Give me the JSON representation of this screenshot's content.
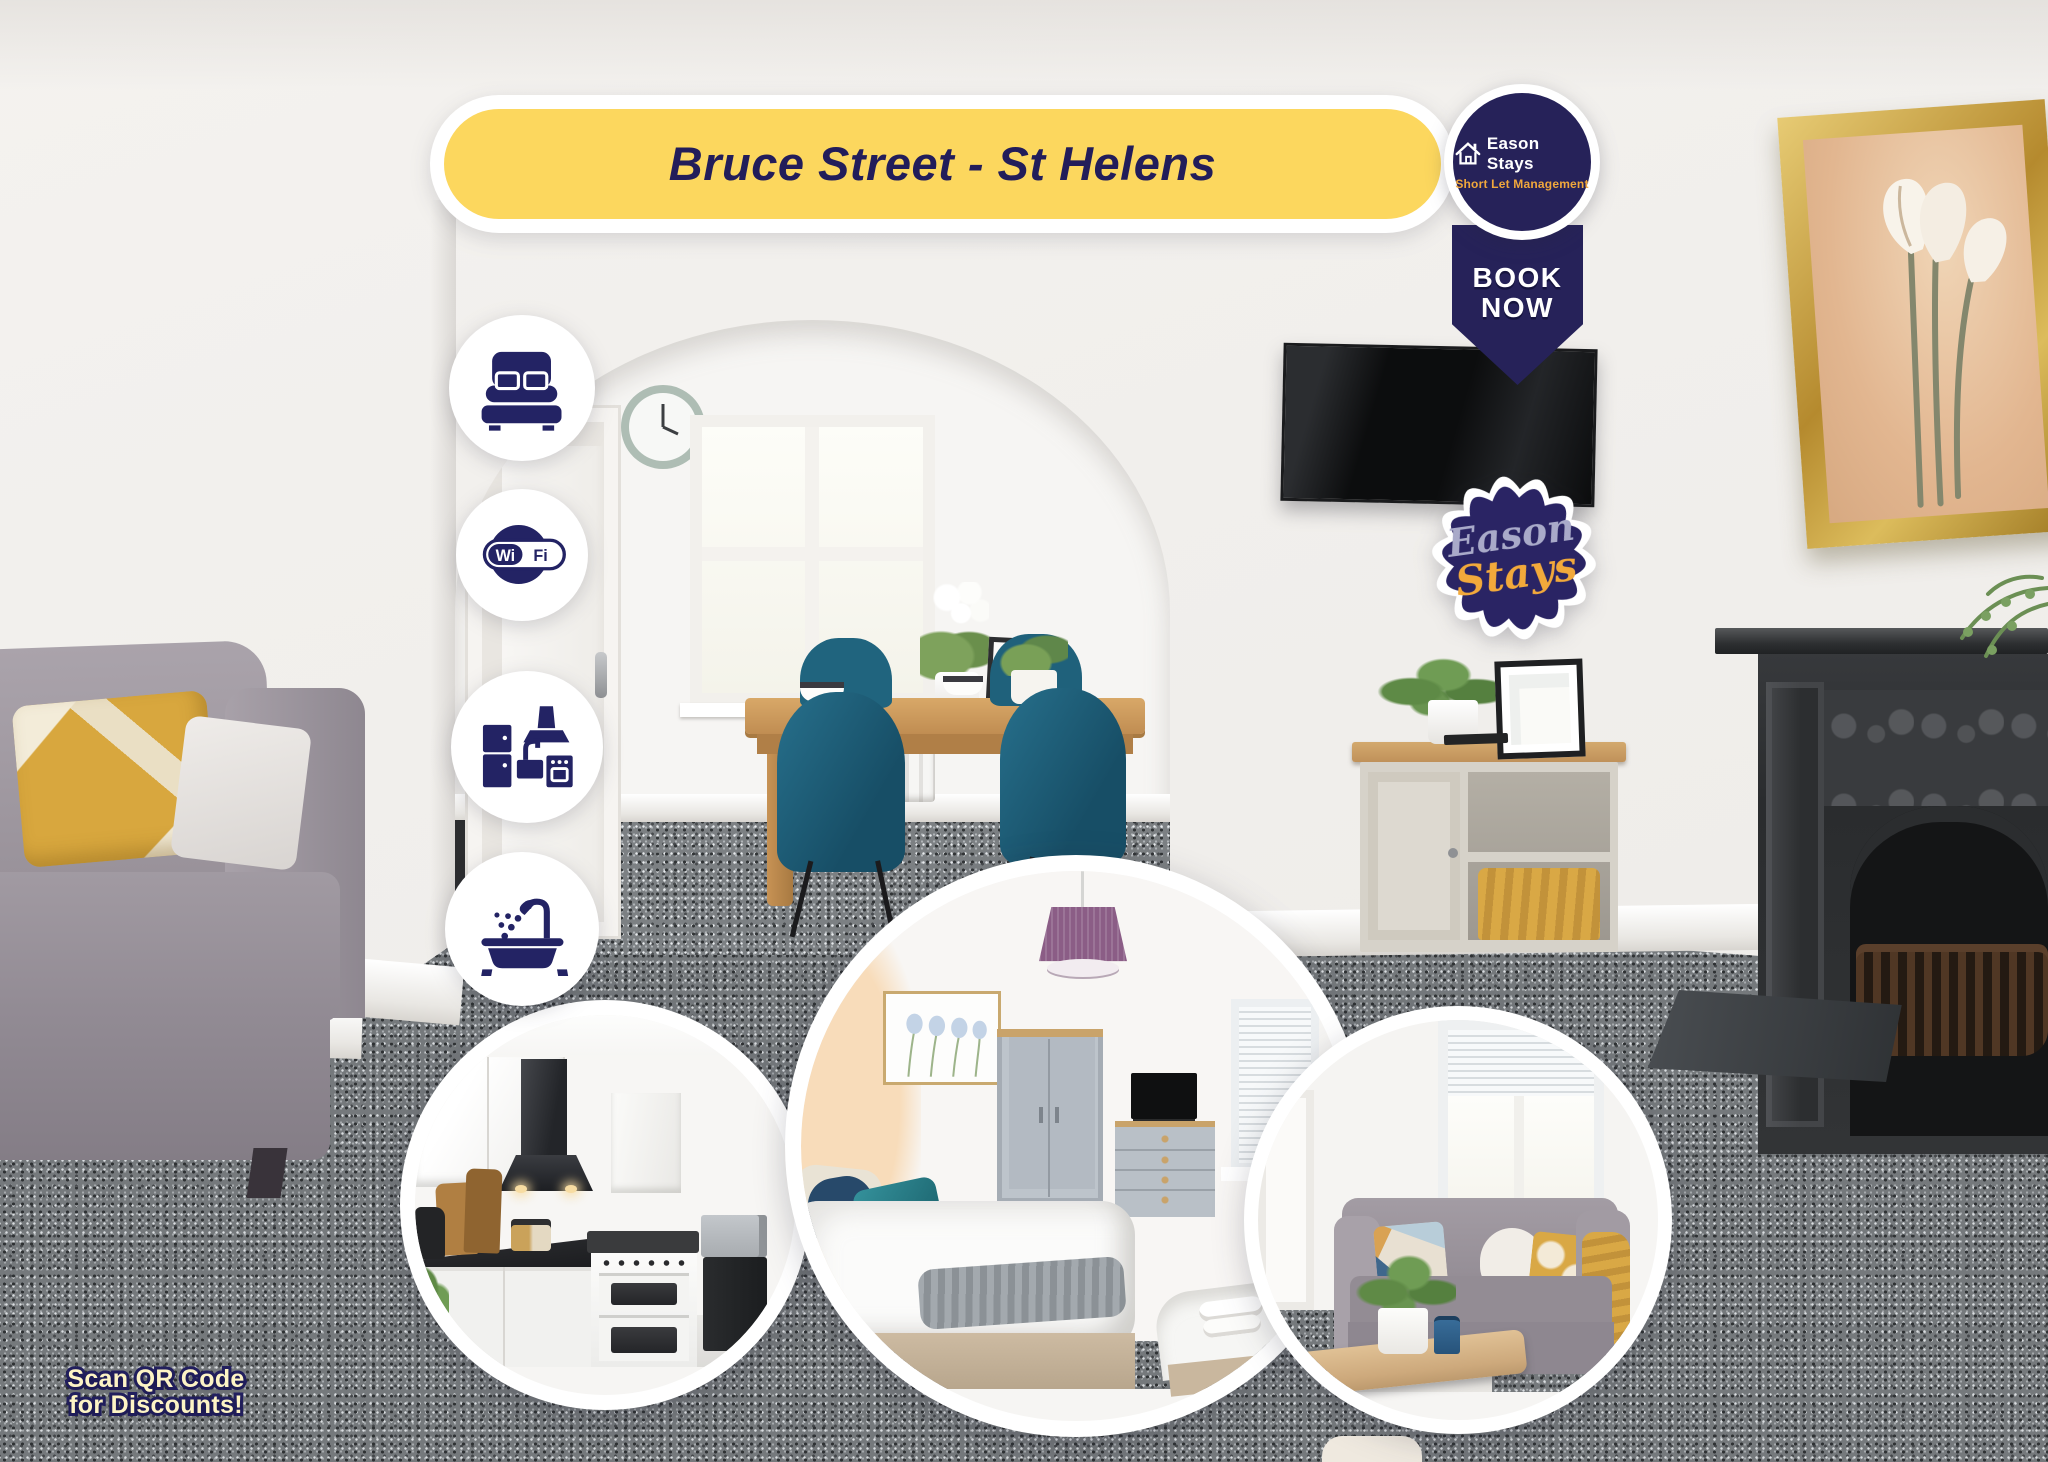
{
  "banner": {
    "title": "Bruce Street - St Helens",
    "bg_color": "#FCD75E",
    "text_color": "#221D5A"
  },
  "brand_badge": {
    "name": "Eason Stays",
    "tagline": "Short Let Management",
    "bg_color": "#262259",
    "name_color": "#FFFFFF",
    "tagline_color": "#F0A73C",
    "icon": "house-icon"
  },
  "book_ribbon": {
    "line1": "BOOK",
    "line2": "NOW",
    "bg_color": "#262259",
    "text_color": "#FFFFFF"
  },
  "stamp": {
    "word1": "Eason",
    "word2": "Stays",
    "word1_color": "#A9AAC9",
    "word2_color": "#F2A93B",
    "bg_color": "#2A2464"
  },
  "amenities": [
    {
      "icon": "bed-icon"
    },
    {
      "icon": "wifi-icon",
      "text_left": "Wi",
      "text_right": "Fi"
    },
    {
      "icon": "kitchen-icon"
    },
    {
      "icon": "bath-icon"
    }
  ],
  "footer_note": {
    "line1": "Scan QR Code",
    "line2": "for Discounts!",
    "text_color": "#FDF4C5",
    "outline_color": "#232060"
  },
  "palette": {
    "navy": "#232364",
    "yellow": "#FCD75E",
    "orange": "#F0A73C",
    "periwinkle": "#A9AAC9",
    "cream": "#FDF4C5",
    "carpet_grey": "#75797C",
    "teal_chair": "#1D617C",
    "oak": "#C99154",
    "sofa_grey": "#9E97A0",
    "wall": "#F2F0EE"
  }
}
